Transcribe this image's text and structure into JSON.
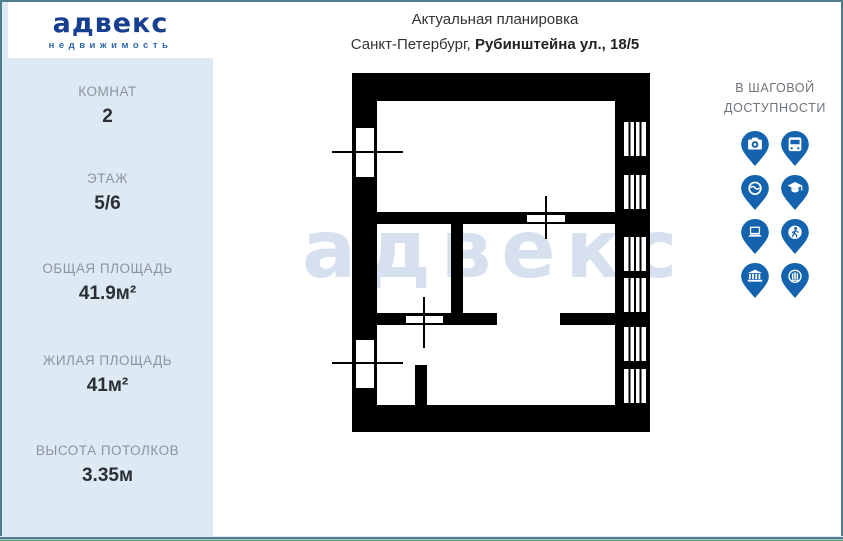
{
  "sidebar": {
    "logo": "адвекс",
    "logo_subtitle": "недвижимость",
    "stats": [
      {
        "label": "КОМНАТ",
        "value": "2"
      },
      {
        "label": "ЭТАЖ",
        "value": "5/6"
      },
      {
        "label": "ОБЩАЯ ПЛОЩАДЬ",
        "value": "41.9м²"
      },
      {
        "label": "ЖИЛАЯ ПЛОЩАДЬ",
        "value": "41м²"
      },
      {
        "label": "ВЫСОТА ПОТОЛКОВ",
        "value": "3.35м"
      }
    ]
  },
  "header": {
    "title": "Актуальная планировка",
    "city": "Санкт-Петербург,",
    "address": "Рубинштейна ул., 18/5"
  },
  "watermark": "адвекс",
  "nearby": {
    "title_line1": "В ШАГОВОЙ",
    "title_line2": "ДОСТУПНОСТИ",
    "pins": [
      {
        "icon": "camera-icon"
      },
      {
        "icon": "bus-icon"
      },
      {
        "icon": "steering-wheel-icon"
      },
      {
        "icon": "graduation-cap-icon"
      },
      {
        "icon": "laptop-icon"
      },
      {
        "icon": "pedestrian-icon"
      },
      {
        "icon": "bank-icon"
      },
      {
        "icon": "columns-circle-icon"
      }
    ]
  },
  "colors": {
    "pin_blue": "#1463af",
    "logo_navy": "#173f8f",
    "logo_blue": "#2f68ad",
    "sidebar_bg": "#dde9f3",
    "frame_border": "#4f7d8e",
    "watermark": "#d7e0ee",
    "plan_walls": "#000000"
  }
}
